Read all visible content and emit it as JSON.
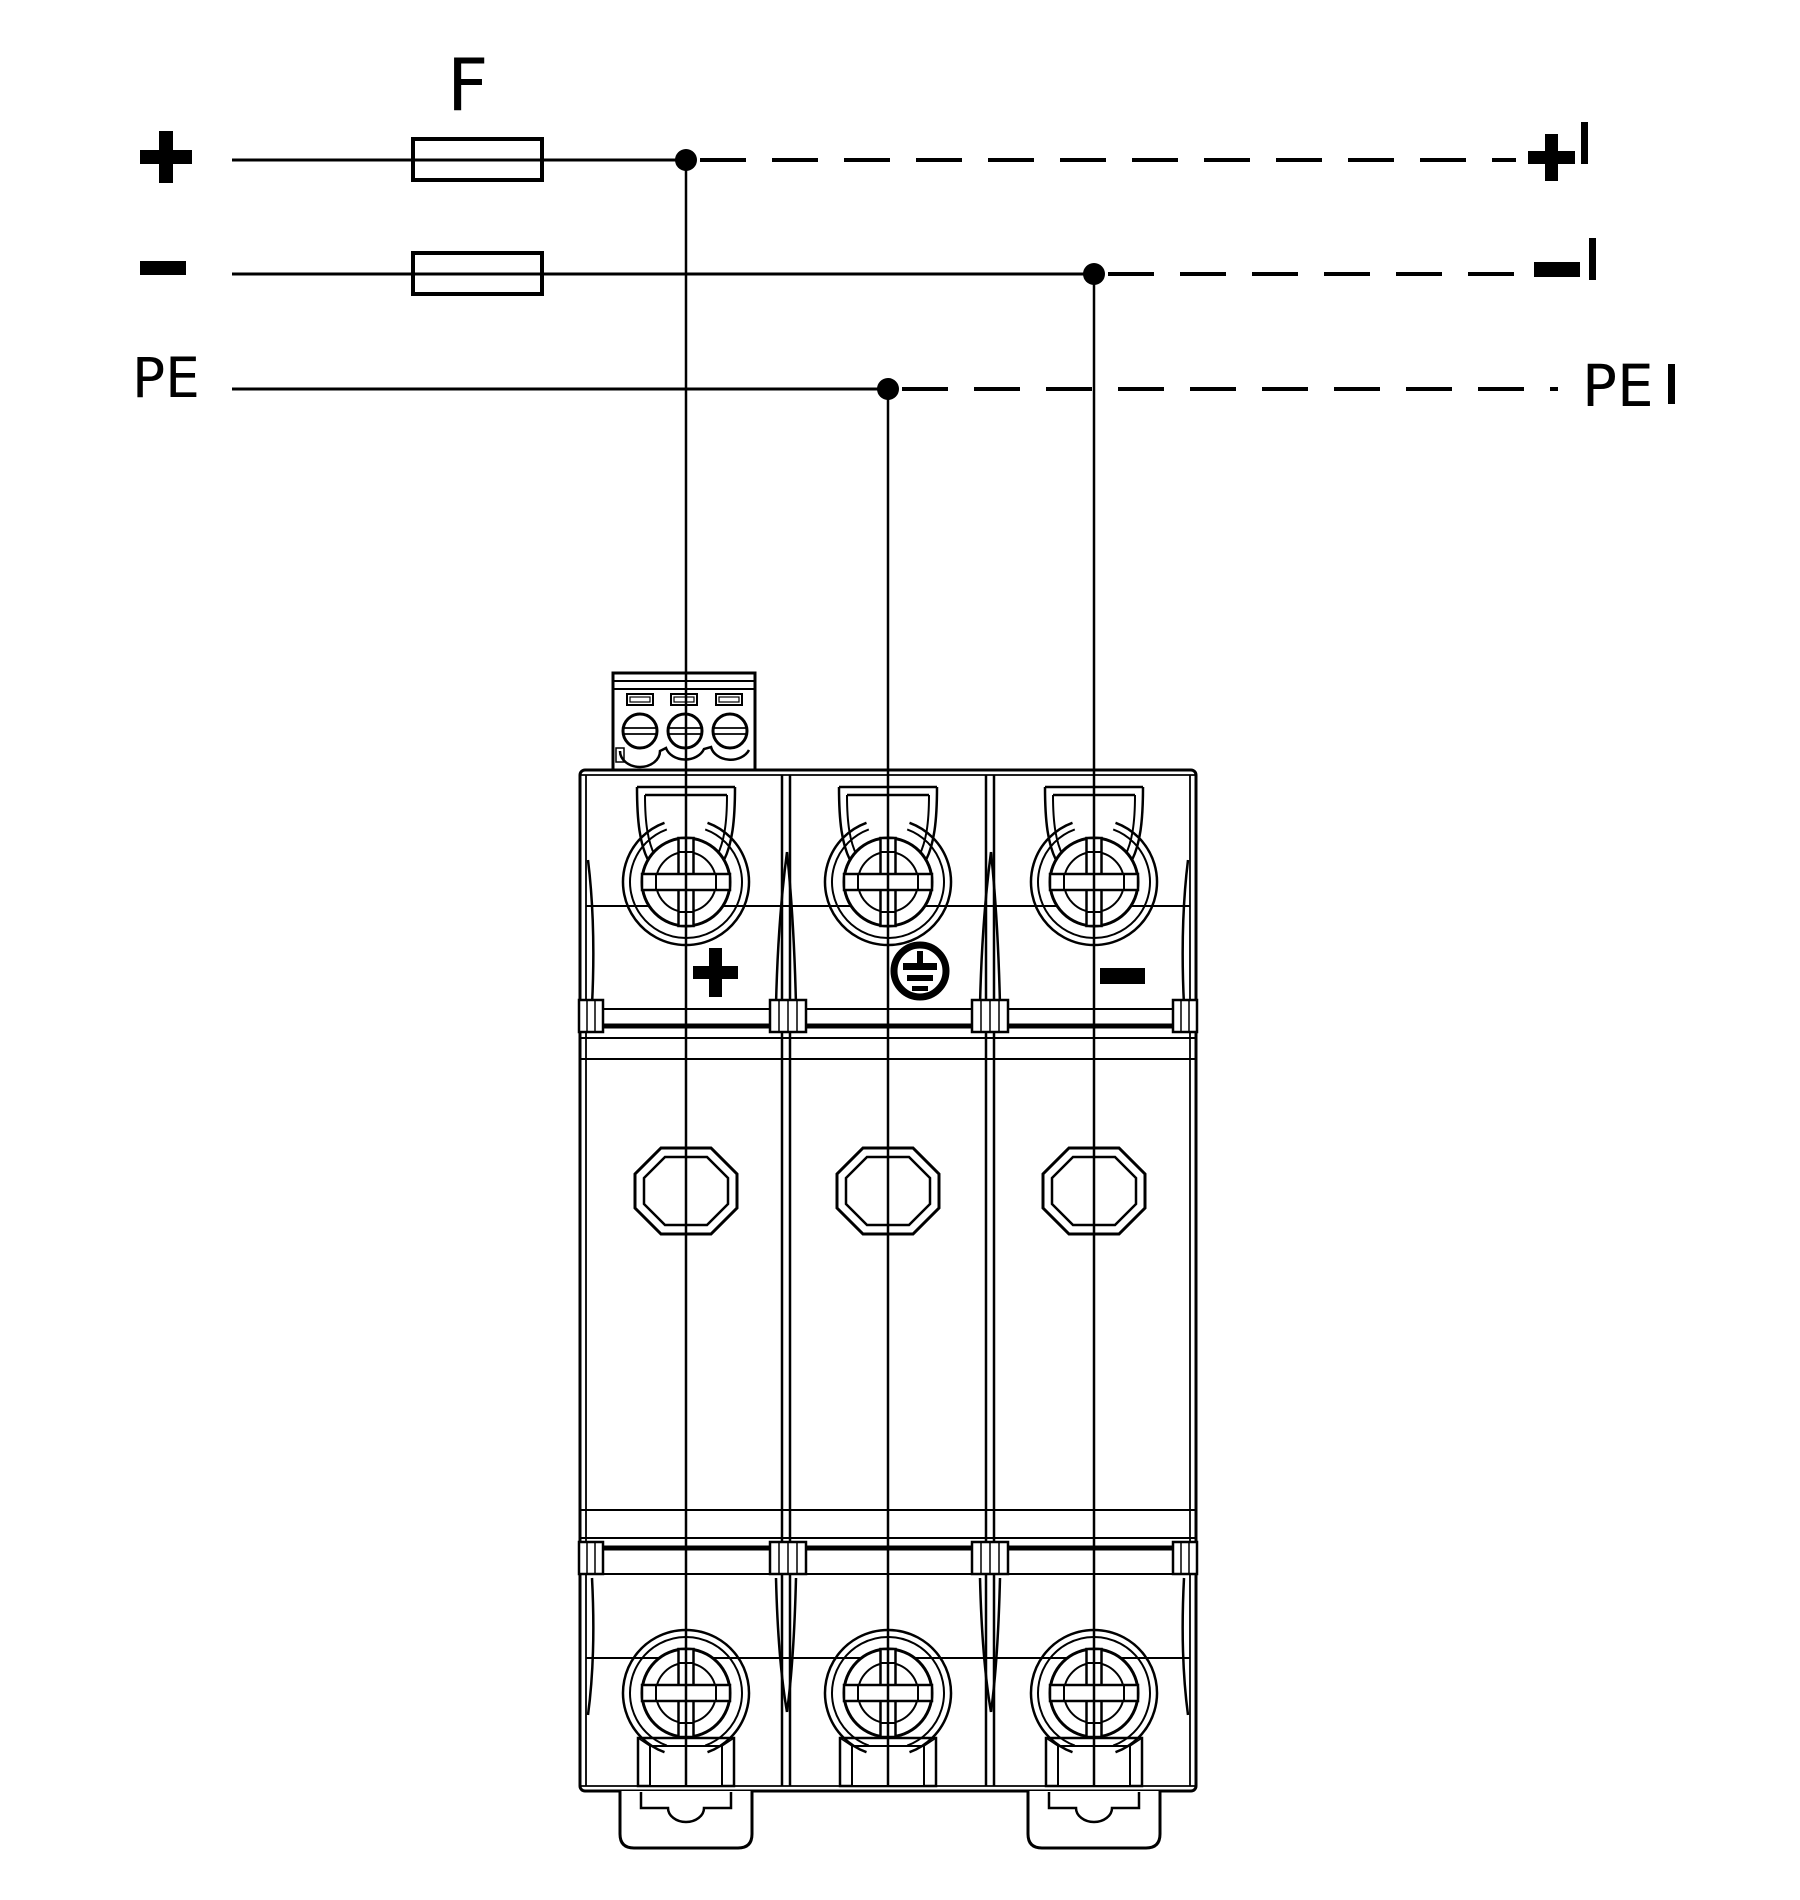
{
  "page": {
    "background": "#ffffff",
    "line_color": "#000000"
  },
  "wiring": {
    "fuse_label": "F",
    "rows": [
      {
        "name": "positive",
        "input_label": "+",
        "output_label": "+'",
        "output_sign": "+",
        "output_prime": "'",
        "has_fuse": true,
        "line_style": "solid then dashed after junction"
      },
      {
        "name": "negative",
        "input_label": "−",
        "output_label": "−'",
        "output_sign": "−",
        "output_prime": "'",
        "has_fuse": true,
        "line_style": "solid then dashed after junction"
      },
      {
        "name": "protective-earth",
        "input_label": "PE",
        "output_label": "PE'",
        "output_text": "PE",
        "output_prime": "'",
        "has_fuse": false,
        "line_style": "solid then dashed after junction"
      }
    ]
  },
  "device": {
    "poles": 3,
    "pole_labels": [
      "+",
      "PE",
      "−"
    ],
    "earth_symbol": "protective-earth"
  }
}
